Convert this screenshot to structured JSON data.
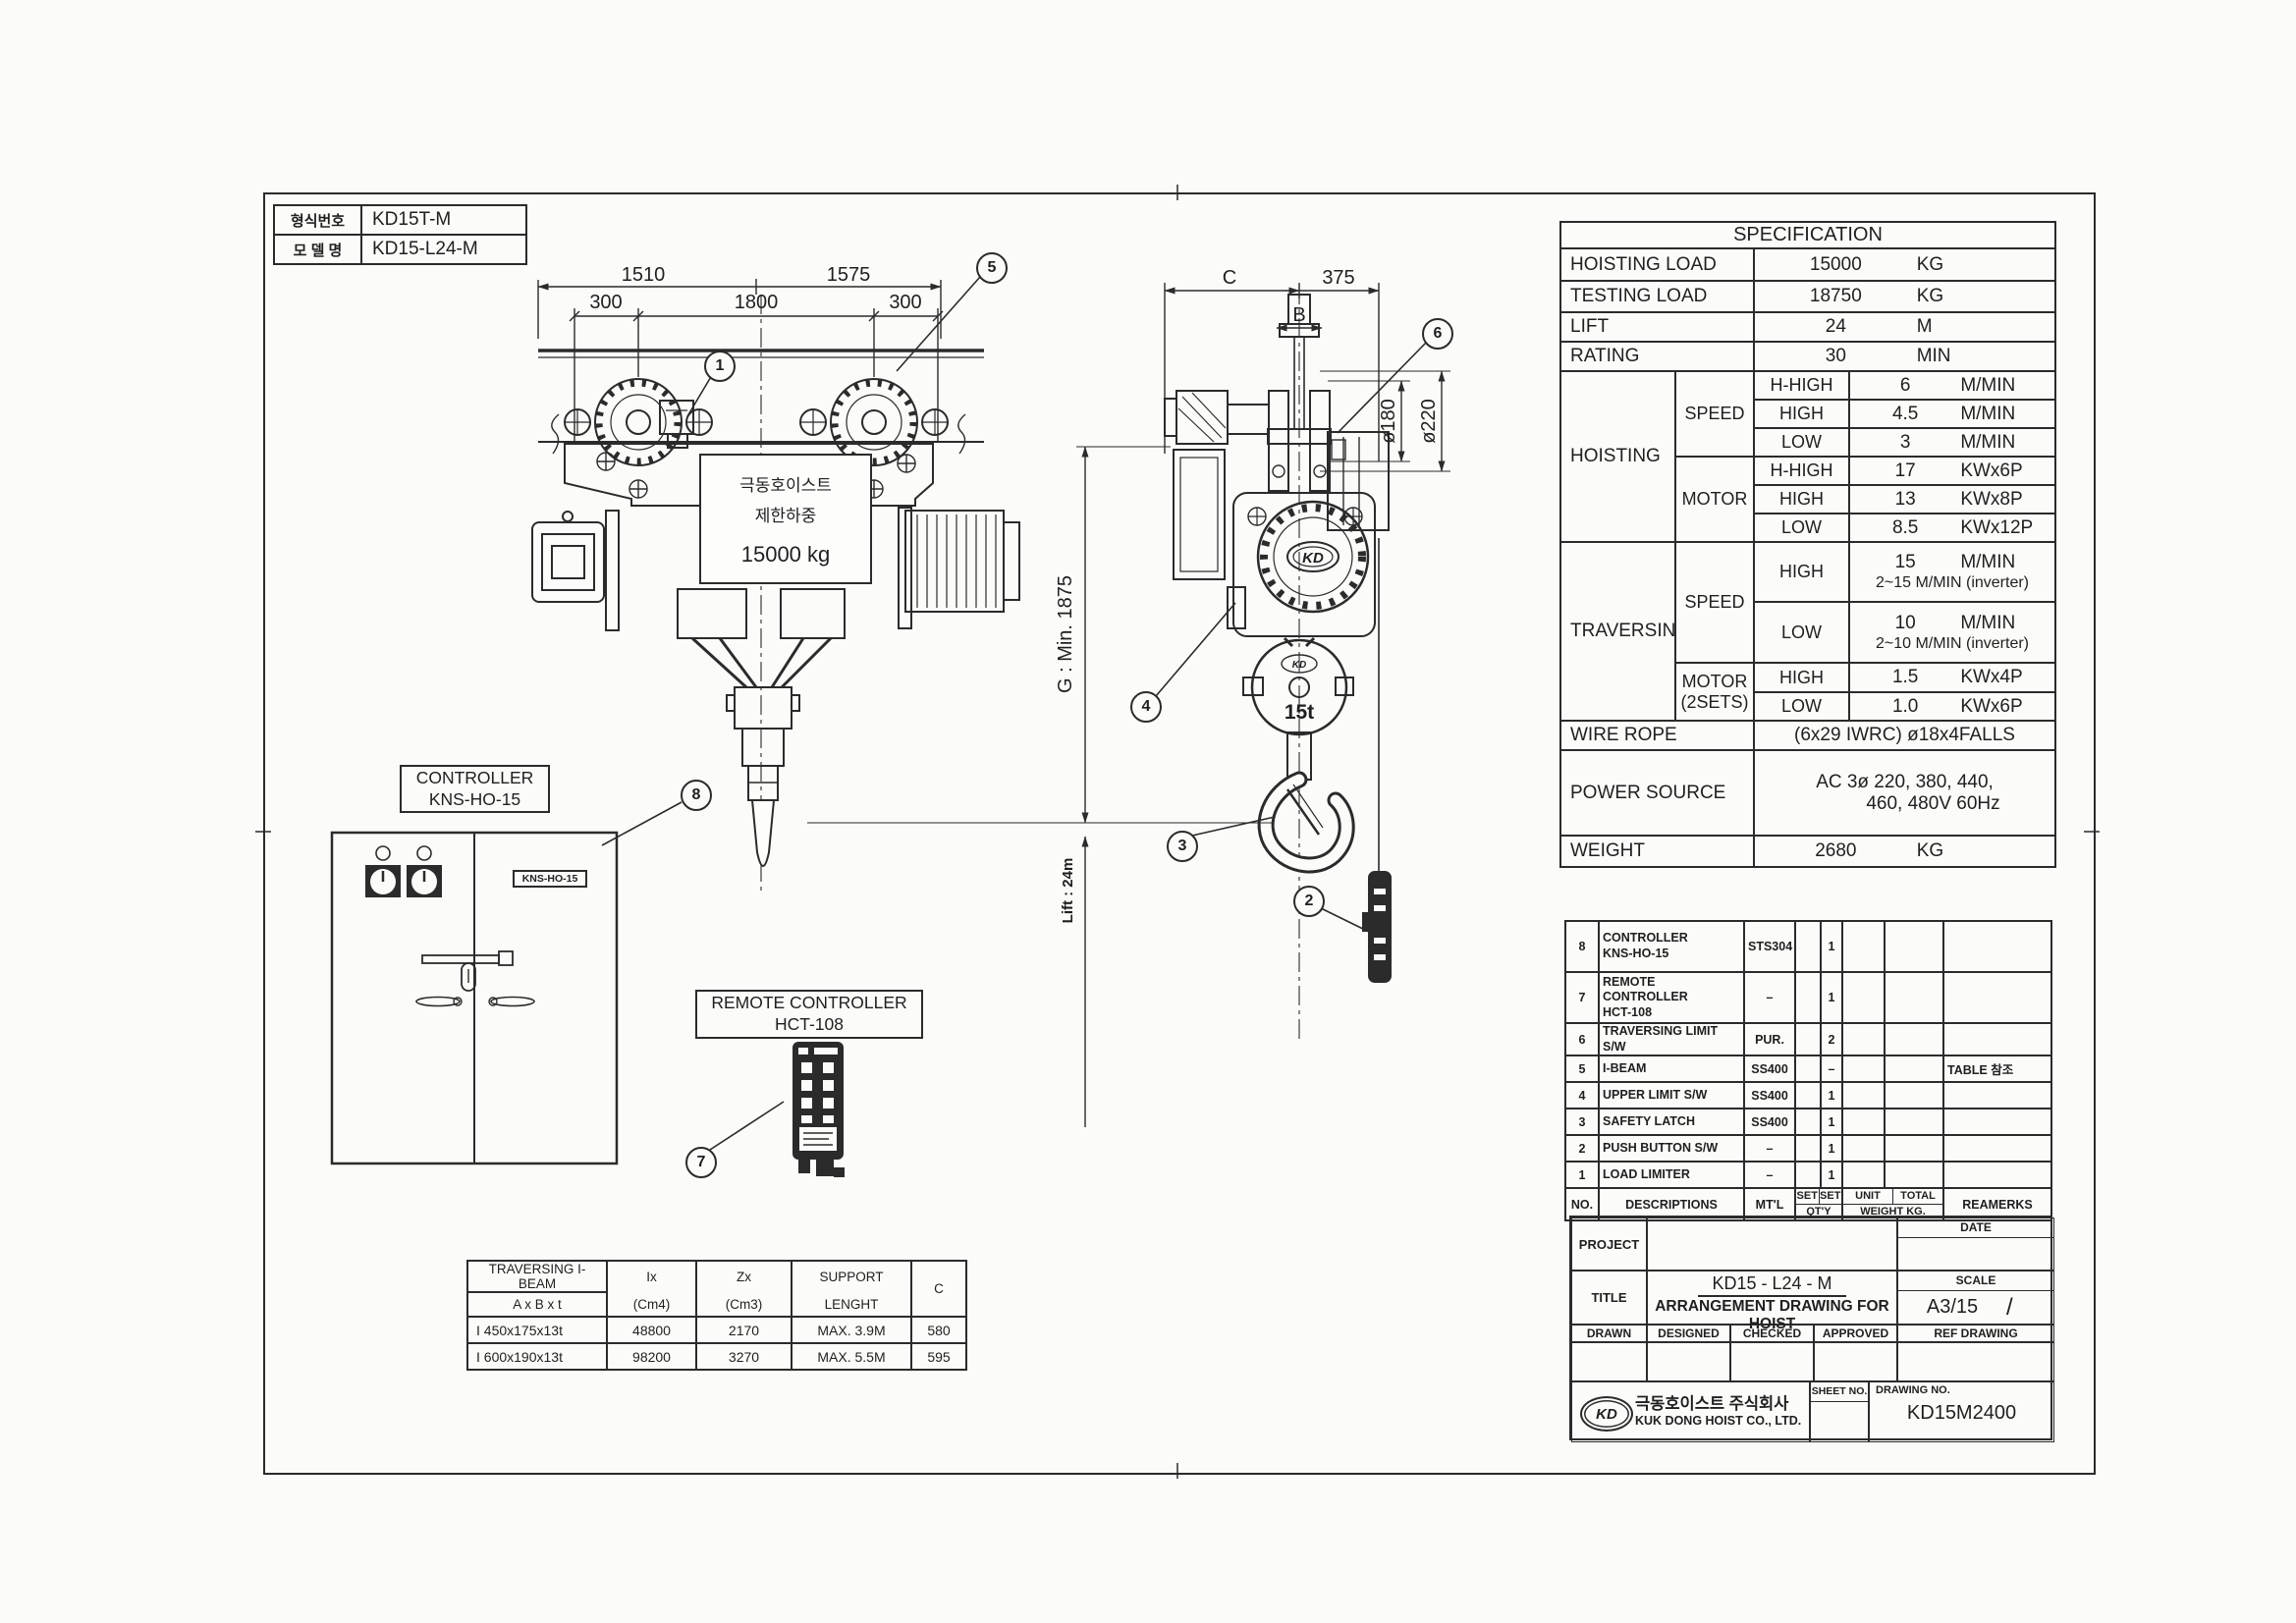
{
  "model_table": {
    "rows": [
      {
        "label": "형식번호",
        "value": "KD15T-M"
      },
      {
        "label": "모 델 명",
        "value": "KD15-L24-M"
      }
    ]
  },
  "front_view": {
    "dims": {
      "top_left": "1510",
      "top_right": "1575",
      "left": "300",
      "center": "1800",
      "right": "300"
    },
    "nameplate": {
      "line1": "극동호이스트",
      "line2": "제한하중",
      "line3": "15000 kg"
    }
  },
  "side_view": {
    "dims": {
      "c": "C",
      "right": "375",
      "flange": "B",
      "wheel": "ø180",
      "wheel_outer": "ø220",
      "headroom": "G : Min. 1875",
      "lift": "Lift : 24m"
    },
    "hook_capacity": "15t",
    "logo": "KD",
    "logo_small": "KD"
  },
  "balloons": {
    "b1": "1",
    "b2": "2",
    "b3": "3",
    "b4": "4",
    "b5": "5",
    "b6": "6",
    "b7": "7",
    "b8": "8"
  },
  "controller": {
    "title1": "CONTROLLER",
    "title2": "KNS-HO-15",
    "nameplate": "KNS-HO-15"
  },
  "remote": {
    "title1": "REMOTE CONTROLLER",
    "title2": "HCT-108"
  },
  "spec": {
    "title": "SPECIFICATION",
    "simple_rows": [
      {
        "label": "HOISTING LOAD",
        "value": "15000",
        "unit": "KG"
      },
      {
        "label": "TESTING LOAD",
        "value": "18750",
        "unit": "KG"
      },
      {
        "label": "LIFT",
        "value": "24",
        "unit": "M"
      },
      {
        "label": "RATING",
        "value": "30",
        "unit": "MIN"
      }
    ],
    "hoisting": {
      "label": "HOISTING",
      "speed_label": "SPEED",
      "motor_label": "MOTOR",
      "speed_rows": [
        {
          "grade": "H-HIGH",
          "value": "6",
          "unit": "M/MIN"
        },
        {
          "grade": "HIGH",
          "value": "4.5",
          "unit": "M/MIN"
        },
        {
          "grade": "LOW",
          "value": "3",
          "unit": "M/MIN"
        }
      ],
      "motor_rows": [
        {
          "grade": "H-HIGH",
          "value": "17",
          "unit": "KWx6P"
        },
        {
          "grade": "HIGH",
          "value": "13",
          "unit": "KWx8P"
        },
        {
          "grade": "LOW",
          "value": "8.5",
          "unit": "KWx12P"
        }
      ]
    },
    "traversing": {
      "label": "TRAVERSING",
      "speed_label": "SPEED",
      "motor_label1": "MOTOR",
      "motor_label2": "(2SETS)",
      "speed_rows": [
        {
          "grade": "HIGH",
          "value": "15",
          "unit": "M/MIN",
          "line2": "2~15 M/MIN (inverter)"
        },
        {
          "grade": "LOW",
          "value": "10",
          "unit": "M/MIN",
          "line2": "2~10 M/MIN (inverter)"
        }
      ],
      "motor_rows": [
        {
          "grade": "HIGH",
          "value": "1.5",
          "unit": "KWx4P"
        },
        {
          "grade": "LOW",
          "value": "1.0",
          "unit": "KWx6P"
        }
      ]
    },
    "wire_rope": {
      "label": "WIRE ROPE",
      "value": "(6x29 IWRC) ø18x4FALLS"
    },
    "power": {
      "label": "POWER SOURCE",
      "line1": "AC 3ø 220, 380, 440,",
      "line2": "460, 480V 60Hz"
    },
    "weight": {
      "label": "WEIGHT",
      "value": "2680",
      "unit": "KG"
    }
  },
  "parts": {
    "header": {
      "no": "NO.",
      "desc": "DESCRIPTIONS",
      "mtl": "MT'L",
      "set1": "SET",
      "set2": "SET",
      "qty": "QT'Y",
      "unit": "UNIT",
      "total": "TOTAL",
      "weight": "WEIGHT KG.",
      "remarks": "REAMERKS"
    },
    "rows": [
      {
        "no": "8",
        "desc1": "CONTROLLER",
        "desc2": "KNS-HO-15",
        "mtl": "STS304",
        "qty": "1"
      },
      {
        "no": "7",
        "desc1": "REMOTE CONTROLLER",
        "desc2": "HCT-108",
        "mtl": "–",
        "qty": "1"
      },
      {
        "no": "6",
        "desc1": "TRAVERSING LIMIT S/W",
        "mtl": "PUR.",
        "qty": "2"
      },
      {
        "no": "5",
        "desc1": "I-BEAM",
        "mtl": "SS400",
        "qty": "–",
        "remarks": "TABLE 참조"
      },
      {
        "no": "4",
        "desc1": "UPPER LIMIT S/W",
        "mtl": "SS400",
        "qty": "1"
      },
      {
        "no": "3",
        "desc1": "SAFETY LATCH",
        "mtl": "SS400",
        "qty": "1"
      },
      {
        "no": "2",
        "desc1": "PUSH BUTTON S/W",
        "mtl": "–",
        "qty": "1"
      },
      {
        "no": "1",
        "desc1": "LOAD LIMITER",
        "mtl": "–",
        "qty": "1"
      }
    ]
  },
  "beam_table": {
    "header": {
      "c1a": "TRAVERSING I-BEAM",
      "c1b": "A x B x t",
      "c2a": "Ix",
      "c2b": "(Cm4)",
      "c3a": "Zx",
      "c3b": "(Cm3)",
      "c4a": "SUPPORT",
      "c4b": "LENGHT",
      "c5": "C"
    },
    "rows": [
      {
        "size": "I 450x175x13t",
        "ix": "48800",
        "zx": "2170",
        "support": "MAX. 3.9M",
        "c": "580"
      },
      {
        "size": "I 600x190x13t",
        "ix": "98200",
        "zx": "3270",
        "support": "MAX. 5.5M",
        "c": "595"
      }
    ]
  },
  "title_block": {
    "project_label": "PROJECT",
    "date_label": "DATE",
    "title_label": "TITLE",
    "title_line1": "KD15 - L24 - M",
    "title_line2": "ARRANGEMENT DRAWING FOR HOIST",
    "scale_label": "SCALE",
    "scale_value": "A3/15",
    "scale_extra": "/",
    "drawn": "DRAWN",
    "designed": "DESIGNED",
    "checked": "CHECKED",
    "approved": "APPROVED",
    "ref": "REF DRAWING",
    "logo": "KD",
    "company_kr": "극동호이스트 주식회사",
    "company_en": "KUK DONG HOIST CO., LTD.",
    "sheet_label": "SHEET NO.",
    "drawing_label": "DRAWING NO.",
    "drawing_no": "KD15M2400"
  }
}
